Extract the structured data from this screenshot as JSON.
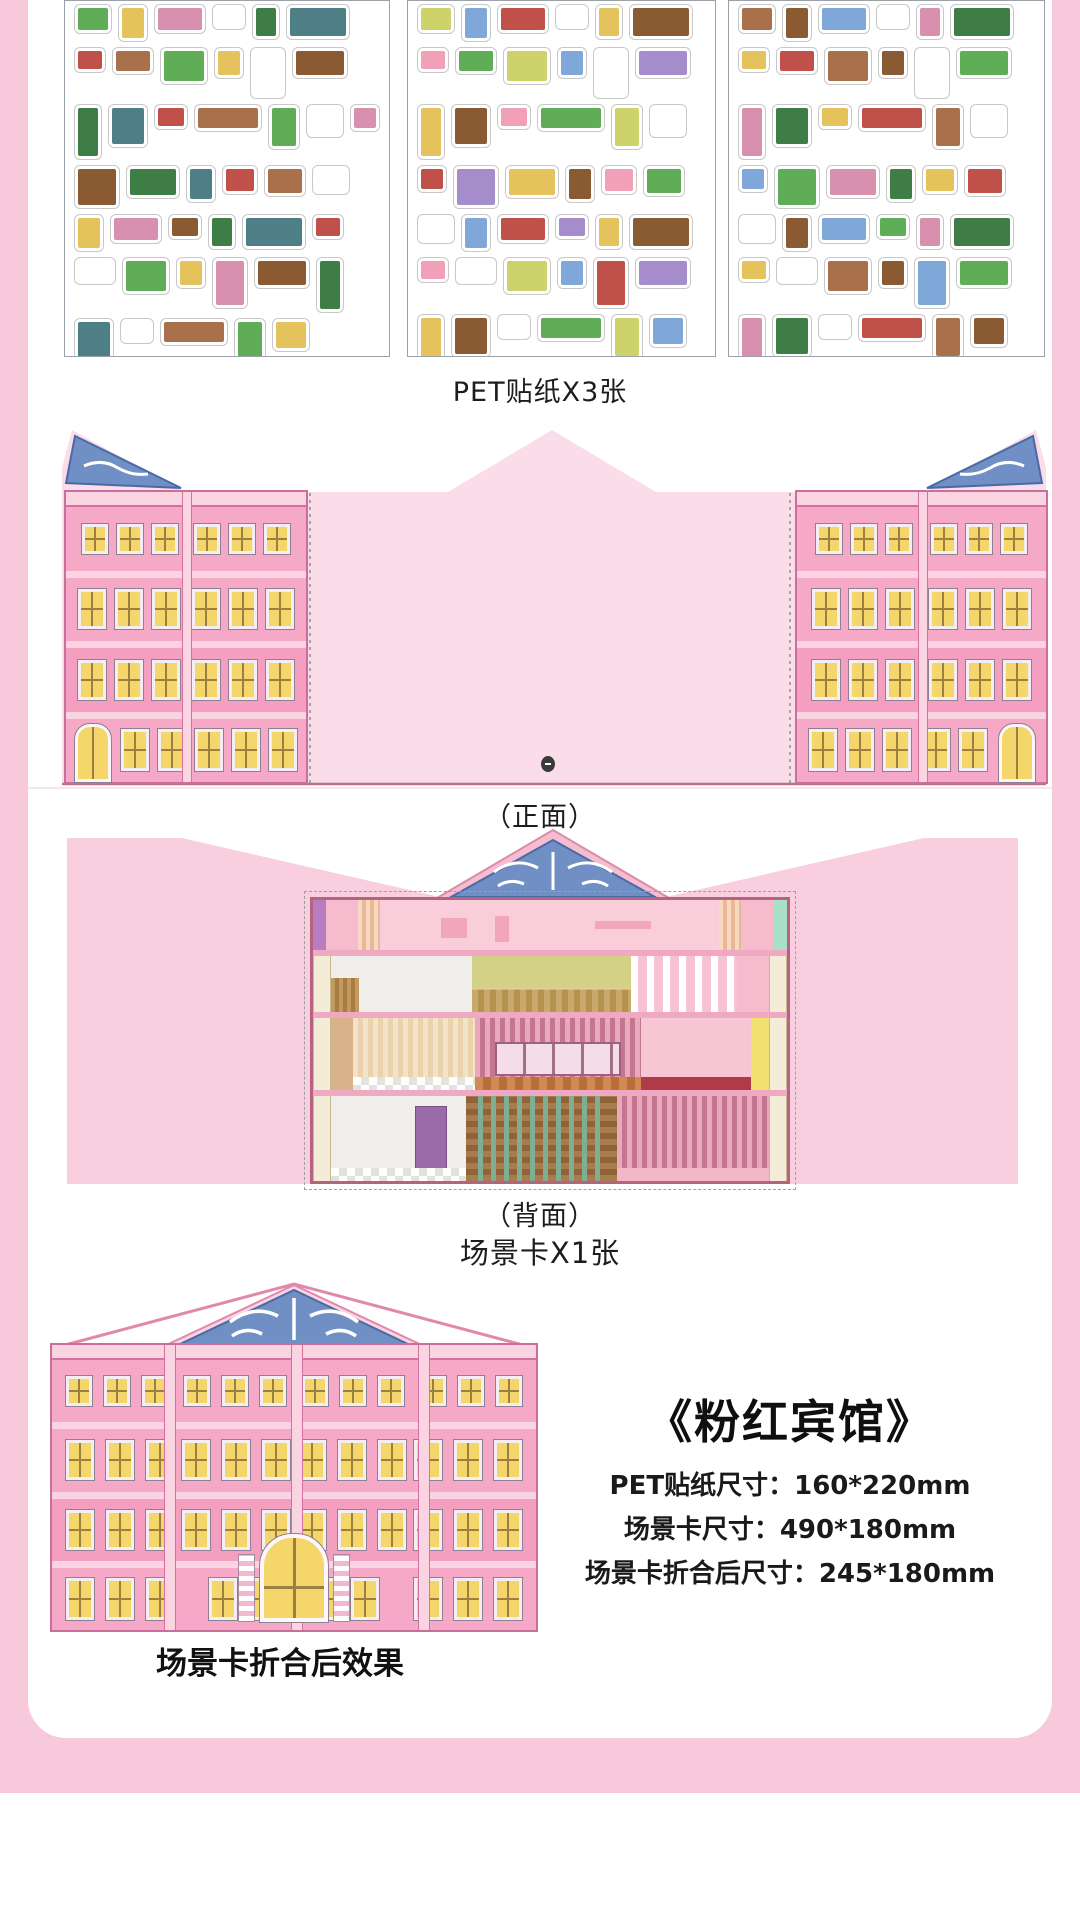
{
  "page": {
    "background_pink": "#f7c9da",
    "card_background": "#ffffff"
  },
  "sections": {
    "stickers": {
      "label": "PET贴纸X3张",
      "sheet_count": 3
    },
    "front": {
      "label": "（正面）"
    },
    "back": {
      "label": "（背面）",
      "card_label": "场景卡X1张"
    },
    "folded": {
      "label": "场景卡折合后效果"
    }
  },
  "product": {
    "title": "《粉红宾馆》",
    "specs": [
      "PET贴纸尺寸：160*220mm",
      "场景卡尺寸：490*180mm",
      "场景卡折合后尺寸：245*180mm"
    ]
  },
  "sheets": [
    {
      "name": "sticker-sheet-1",
      "palette": [
        "#5fae57",
        "#8a5a33",
        "#c0504a",
        "#e4c35c",
        "#3f7d46",
        "#a9714b",
        "#d98fae",
        "#4f7f86"
      ]
    },
    {
      "name": "sticker-sheet-2",
      "palette": [
        "#cdd36a",
        "#a58ccb",
        "#f2a0b8",
        "#7fa8d9",
        "#e4c35c",
        "#5fae57",
        "#c0504a",
        "#8a5a33"
      ]
    },
    {
      "name": "sticker-sheet-3",
      "palette": [
        "#a9714b",
        "#5fae57",
        "#e4c35c",
        "#8a5a33",
        "#d98fae",
        "#c0504a",
        "#7fa8d9",
        "#3f7d46"
      ]
    }
  ],
  "colors": {
    "page_pink": "#f7c9da",
    "scene_card_pink": "#fbdce9",
    "back_card_pink": "#f9cfdf",
    "facade_pink": "#f6a9c7",
    "facade_light_band": "#fbd4e2",
    "facade_dark_line": "#d4719e",
    "pediment_blue": "#6f8fc5",
    "window_yellow": "#f5d66b"
  }
}
